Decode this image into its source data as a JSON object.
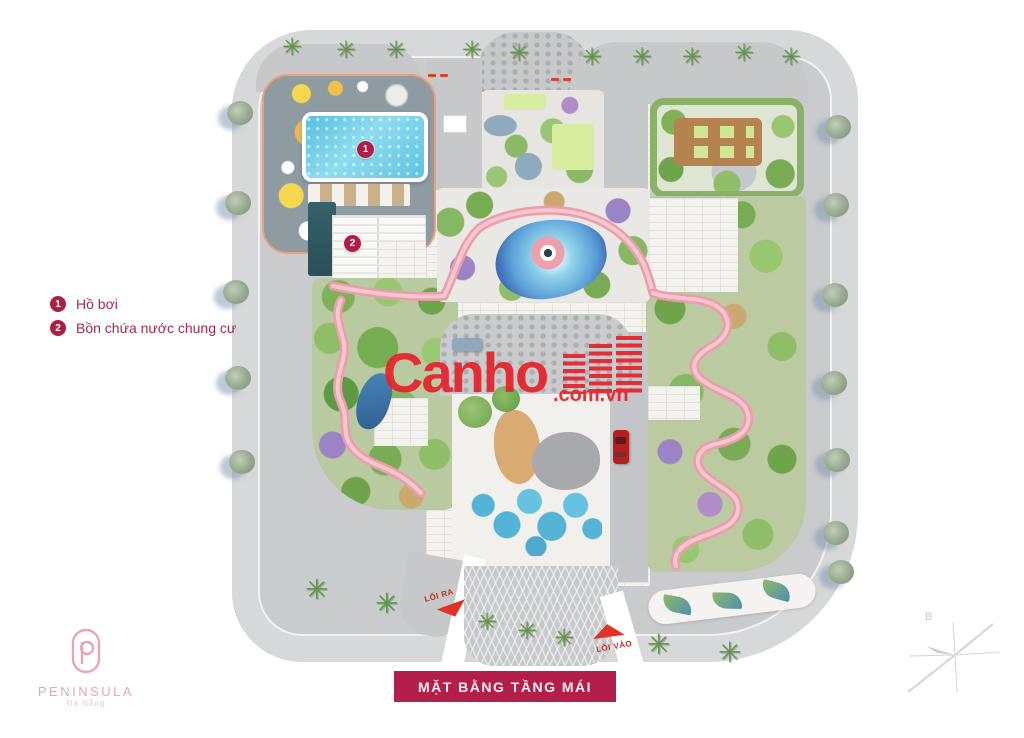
{
  "legend": {
    "items": [
      {
        "num": "1",
        "label": "Hồ bơi"
      },
      {
        "num": "2",
        "label": "Bồn chứa nước chung cư"
      }
    ],
    "badge_color": "#AD1F47",
    "text_color": "#A22A4D"
  },
  "plan": {
    "markers": [
      {
        "num": "1"
      },
      {
        "num": "2"
      }
    ],
    "exit_label": "LỐI RA",
    "entrance_label": "LỐI VÀO"
  },
  "watermark": {
    "brand": "Canho",
    "domain": ".com.vn",
    "color": "#E7232A"
  },
  "banner": {
    "title": "MẶT BẰNG TẦNG MÁI",
    "background": "#B31E4A",
    "text_color": "#FDEFF4"
  },
  "logo": {
    "name": "PENINSULA",
    "subtitle": "Đà Nẵng",
    "color": "#E3A8B7"
  },
  "compass": {
    "north_label": "B"
  },
  "icons": {
    "palm": "✳"
  },
  "colors": {
    "pool_blue": "#5EC3E2",
    "track_pink": "#EC9DAC",
    "road_gray": "#C9CBCD",
    "garden_green": "#86B763",
    "accent_crimson": "#AD1F47"
  }
}
